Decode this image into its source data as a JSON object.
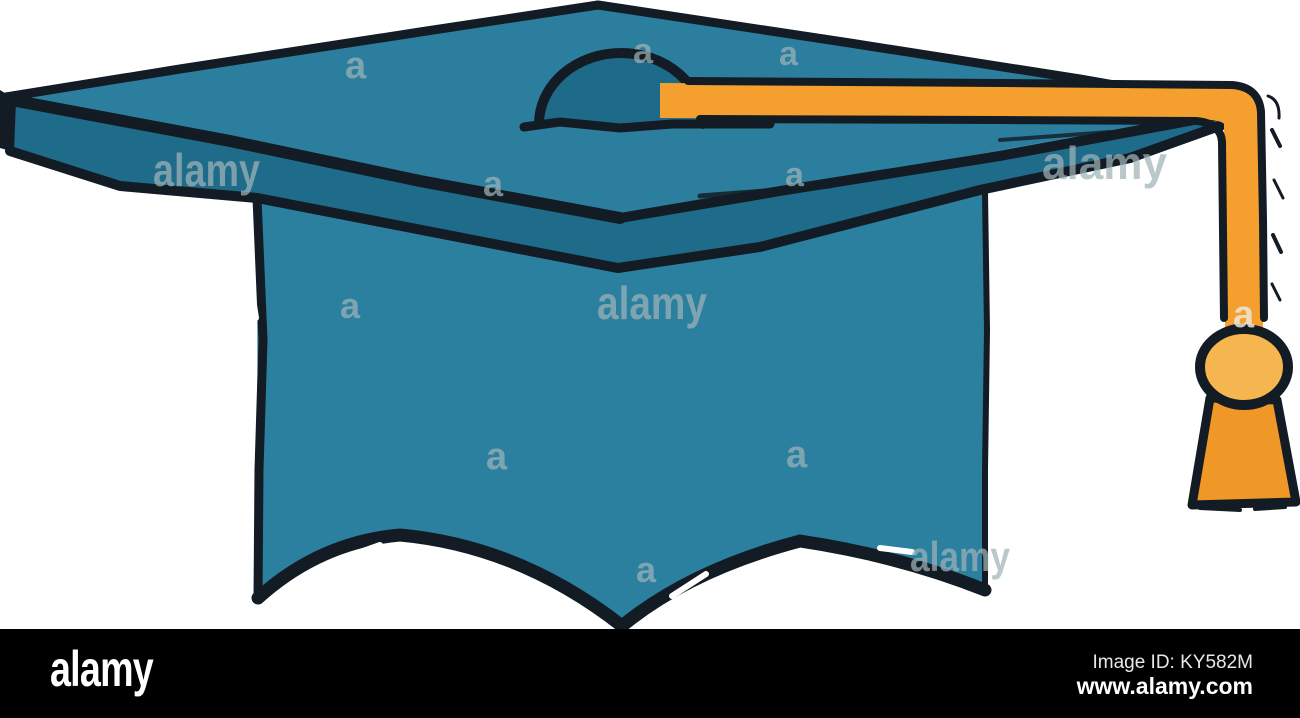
{
  "image": {
    "description": "Sketch style drawing of a teal graduation cap (mortarboard) with an orange tassel hanging on the right side",
    "subject": "graduation cap hat illustration",
    "style": "hand-drawn doodle with rough black outlines",
    "colors": {
      "background": "#ffffff",
      "cap_top": "#2b7e9d",
      "cap_underside": "#1e6b8a",
      "cap_body": "#2b80a0",
      "button_dome": "#1d6a89",
      "outline_black": "#131c24",
      "tassel_cord": "#f5a02e",
      "tassel_ball": "#f6b64f",
      "tassel_fringe": "#ef9727",
      "watermark_gray": "#9fb3b8",
      "footer_bar": "#000000"
    }
  },
  "watermark": {
    "word": "alamy",
    "letter": "a"
  },
  "footer": {
    "logo": "alamy",
    "image_id": "Image ID: KY582M",
    "website": "www.alamy.com"
  }
}
